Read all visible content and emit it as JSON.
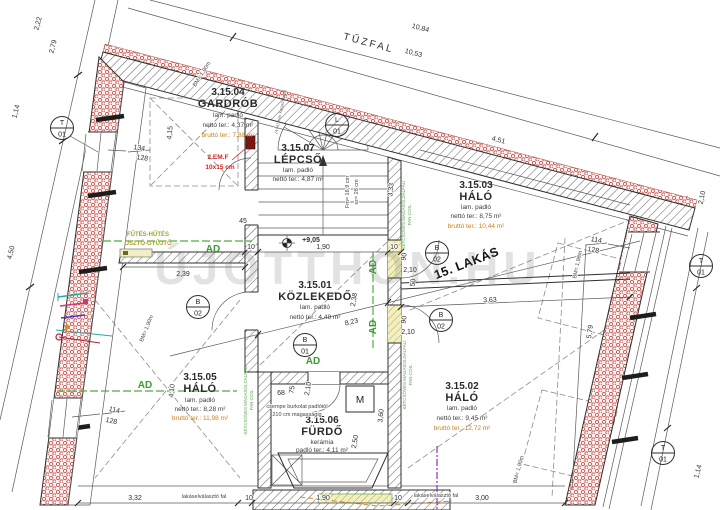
{
  "rooms": {
    "gardrob": {
      "no": "3.15.04",
      "name": "GARDRÓB",
      "floor": "lam. padló",
      "net": "nettó ter.: 4,37 m²",
      "gross": "bruttó ter.: 7,88 m²"
    },
    "lepcso": {
      "no": "3.15.07",
      "name": "LÉPCSŐ",
      "floor": "lam. padló",
      "net": "nettó ter.: 4,87 m²"
    },
    "halo3": {
      "no": "3.15.03",
      "name": "HÁLÓ",
      "floor": "lam. padló",
      "net": "nettó ter.: 8,75 m²",
      "gross": "bruttó ter.: 10,44 m²"
    },
    "kozlekedo": {
      "no": "3.15.01",
      "name": "KÖZLEKEDŐ",
      "floor": "lam. padló",
      "net": "nettó ter.: 4,48 m²"
    },
    "halo5": {
      "no": "3.15.05",
      "name": "HÁLÓ",
      "floor": "lam. padló",
      "net": "nettó ter.: 8,28 m²",
      "gross": "bruttó ter.: 11,98 m²"
    },
    "halo2": {
      "no": "3.15.02",
      "name": "HÁLÓ",
      "floor": "lam. padló",
      "net": "nettó ter.: 9,45 m²",
      "gross": "bruttó ter.: 12,72 m²"
    },
    "furdo": {
      "no": "3.15.06",
      "name": "FÜRDŐ",
      "floor": "kerámia",
      "net": "padló ter.: 4,11 m²"
    }
  },
  "labels": {
    "tuzfal": "TŰZFAL",
    "apartment": "15. LAKÁS",
    "watermark": "ÚJOTTHON.HU",
    "ad": "AD",
    "fancoil_line1": "KÉTCSÖVES MAGASOLDALFALI",
    "fancoil_line2": "FAN-COIL",
    "futes_line1": "FŰTÉS-HŰTÉS",
    "futes_line2": "OSZTÓ-GYŰJTŐ",
    "emf": "2.EM.F",
    "emf_size": "10x15 cm",
    "level": "+9,05",
    "csempe_line1": "csempe burkolat padlótól",
    "csempe_line2": "210 cm magasságig",
    "stair_rise": "Fm= 16,9 cm",
    "stair_going": "sz= 28 cm",
    "handrail": "(4+4) mm kapaszkodó",
    "separating_wall": "lakáselválasztó fal",
    "bm190": "BM= 1,90m",
    "bm198": "BM= 1,98m",
    "machine": "M"
  },
  "dims": {
    "v1084": "10,84",
    "v1053": "10,53",
    "v451": "4,51",
    "v222": "2,22",
    "v279": "2,79",
    "v114": "1,14",
    "v450": "4,50",
    "v239": "2,39",
    "v45": "45",
    "v10": "10",
    "v190": "1,90",
    "v415": "4,15",
    "v410": "4,10",
    "v823": "8,23",
    "v238": "2,38",
    "v333": "3,33",
    "v360": "3,60",
    "v90": "90",
    "v50": "50",
    "v210": "2,10",
    "v363": "3,63",
    "v579": "5,79",
    "v332": "3,32",
    "v300": "3,00",
    "v75": "75",
    "v68": "68",
    "v250": "2,50",
    "w134": "134",
    "w128": "128",
    "w114": "114"
  },
  "markers": {
    "t": "T",
    "l": "L",
    "b": "B",
    "n01": "01",
    "n02": "02"
  },
  "colors": {
    "insulation": "#c4534d",
    "green": "#3d9b35",
    "orange_area": "#c9821c",
    "red_note": "#c8271f",
    "radiator": "#b4ad3c"
  }
}
